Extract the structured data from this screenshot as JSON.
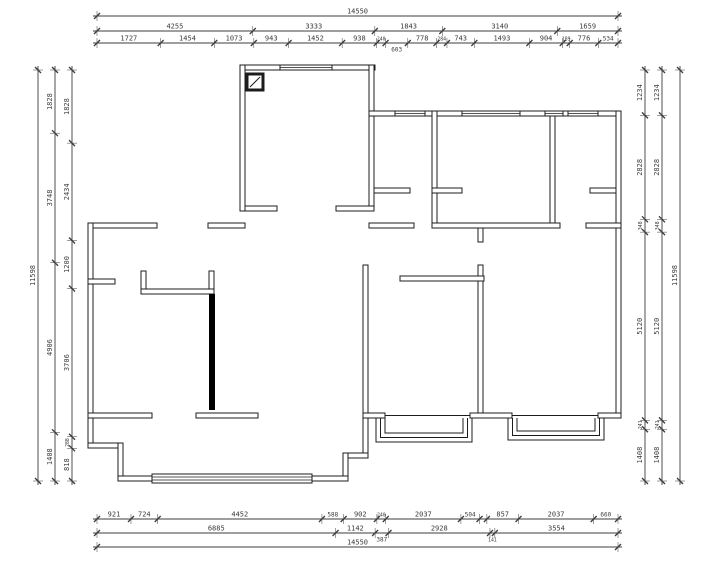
{
  "drawing": {
    "type": "architectural-floor-plan",
    "units": "mm",
    "overall_width_label": "14550",
    "overall_height_label": "11598",
    "colors": {
      "wall": "#1c1c1c",
      "dim": "#3c3c3c",
      "text": "#3a3a3a",
      "solid_wall": "#000000",
      "bg": "#ffffff"
    },
    "dimensions": {
      "top": [
        {
          "pos": 16,
          "from": 97,
          "to": 618,
          "segs": [
            {
              "v": 14550,
              "t": "14550"
            }
          ]
        },
        {
          "pos": 31,
          "from": 97,
          "to": 618,
          "segs": [
            4255,
            3333,
            1843,
            3140,
            1659
          ]
        },
        {
          "pos": 43,
          "from": 97,
          "to": 618,
          "segs": [
            1727,
            1454,
            1073,
            943,
            1452,
            938,
            240,
            {
              "v": 603,
              "t": "603",
              "below": true
            },
            778,
            284,
            743,
            1493,
            904,
            189,
            776,
            534
          ]
        }
      ],
      "bottom": [
        {
          "pos": 519,
          "from": 97,
          "to": 618,
          "segs": [
            921,
            724,
            4452,
            588,
            902,
            240,
            2037,
            504,
            {
              "v": 200,
              "t": ""
            },
            857,
            2037,
            660
          ]
        },
        {
          "pos": 533,
          "from": 97,
          "to": 618,
          "segs": [
            6885,
            1142,
            {
              "v": 387,
              "t": "387",
              "below": true
            },
            2928,
            {
              "v": 141,
              "t": "141",
              "below": true
            },
            3554
          ]
        },
        {
          "pos": 547,
          "from": 97,
          "to": 618,
          "segs": [
            {
              "v": 14550,
              "t": "14550"
            }
          ]
        }
      ],
      "left": [
        {
          "pos": 38,
          "from": 70,
          "to": 481,
          "segs": [
            {
              "v": 11598,
              "t": "11598"
            }
          ]
        },
        {
          "pos": 55,
          "from": 70,
          "to": 481,
          "segs": [
            1828,
            3748,
            4906,
            1408
          ]
        },
        {
          "pos": 72,
          "from": 70,
          "to": 481,
          "segs": [
            1828,
            2434,
            1200,
            3706,
            288,
            818
          ]
        }
      ],
      "right": [
        {
          "pos": 645,
          "from": 70,
          "to": 481,
          "segs": [
            1234,
            2828,
            348,
            5120,
            241,
            1408
          ]
        },
        {
          "pos": 662,
          "from": 70,
          "to": 481,
          "segs": [
            1234,
            2828,
            348,
            5120,
            241,
            1408
          ]
        },
        {
          "pos": 680,
          "from": 70,
          "to": 481,
          "segs": [
            {
              "v": 11598,
              "t": "11598"
            }
          ]
        }
      ]
    },
    "plan": {
      "walls": [
        [
          240,
          65,
          135,
          5
        ],
        [
          240,
          65,
          5,
          146
        ],
        [
          369,
          65,
          5,
          146
        ],
        [
          245,
          206,
          32,
          5
        ],
        [
          336,
          206,
          38,
          5
        ],
        [
          374,
          188,
          36,
          5
        ],
        [
          369,
          111,
          252,
          5
        ],
        [
          616,
          111,
          5,
          307
        ],
        [
          432,
          111,
          5,
          117
        ],
        [
          550,
          111,
          5,
          117
        ],
        [
          369,
          223,
          45,
          5
        ],
        [
          432,
          223,
          128,
          5
        ],
        [
          586,
          223,
          35,
          5
        ],
        [
          590,
          188,
          26,
          5
        ],
        [
          432,
          188,
          30,
          5
        ],
        [
          478,
          228,
          5,
          14
        ],
        [
          478,
          265,
          5,
          153
        ],
        [
          400,
          276,
          84,
          5
        ],
        [
          363,
          265,
          5,
          193
        ],
        [
          343,
          453,
          25,
          5
        ],
        [
          343,
          453,
          5,
          28
        ],
        [
          88,
          223,
          69,
          5
        ],
        [
          208,
          223,
          37,
          5
        ],
        [
          88,
          223,
          5,
          225
        ],
        [
          88,
          279,
          27,
          5
        ],
        [
          88,
          443,
          35,
          5
        ],
        [
          118,
          443,
          5,
          38
        ],
        [
          118,
          476,
          230,
          5
        ],
        [
          141,
          271,
          5,
          23
        ],
        [
          209,
          271,
          5,
          23
        ],
        [
          141,
          289,
          73,
          5
        ],
        [
          88,
          413,
          64,
          5
        ],
        [
          196,
          413,
          62,
          5
        ],
        [
          363,
          413,
          22,
          5
        ],
        [
          470,
          413,
          42,
          5
        ],
        [
          598,
          413,
          23,
          5
        ]
      ],
      "solid_walls": [
        [
          209,
          294,
          6,
          116
        ]
      ],
      "windows": [
        [
          280,
          65,
          52,
          5
        ],
        [
          395,
          111,
          30,
          5
        ],
        [
          462,
          111,
          58,
          5
        ],
        [
          545,
          111,
          18,
          5
        ],
        [
          568,
          111,
          30,
          5
        ]
      ],
      "sliding_door": {
        "x": 152,
        "y": 474,
        "w": 160,
        "h": 9
      },
      "bay_windows": [
        {
          "x": 376,
          "y": 418,
          "w": 96,
          "d": 24
        },
        {
          "x": 508,
          "y": 418,
          "w": 96,
          "d": 22
        }
      ],
      "extra_lines": [
        [
          385,
          415.5,
          470,
          415.5
        ],
        [
          512,
          415.5,
          598,
          415.5
        ]
      ],
      "column": {
        "x": 247,
        "y": 74,
        "s": 16
      }
    }
  }
}
